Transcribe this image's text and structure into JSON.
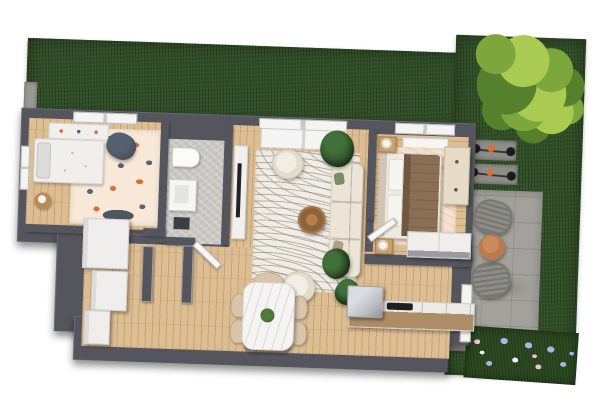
{
  "meta": {
    "title": "3D top-down floor plan rendering of a house with garden",
    "render_type": "architectural-visualization",
    "canvas": {
      "width": 600,
      "height": 420
    }
  },
  "palette": {
    "bg": "#ffffff",
    "grass": "#33502a",
    "treeLight": "#a9cb52",
    "treeMid": "#7da73d",
    "treeDark": "#55802c",
    "wall": "#55555d",
    "wood": "#ddbd92",
    "tile": "#cbc8c3",
    "stone": "#a3a19c",
    "rugCream": "#f1ede5",
    "rugKids": "#f8e8d8",
    "rugBedroom": "#f5e3d0",
    "sofa": "#ece5d7",
    "accentOrange": "#d96f35",
    "terracotta": "#b97a4e",
    "blanket": "#8a6f54",
    "flowerBlue": "#a9b3e6",
    "flowerPink": "#e9c2d8",
    "counterWood": "#ad8d66",
    "cooktop": "#1f1f22",
    "metal": "#b9bcc1"
  },
  "scene": {
    "garden": {
      "lawn_label": "grass lawn",
      "tree_label": "large tree",
      "bicycles_label": "two parked bicycles",
      "patio_label": "stone patio with two wicker chairs and round table",
      "flowerbed_label": "hydrangea flower bed",
      "stone_pad_label": "stone pad"
    },
    "house": {
      "rooms": [
        {
          "key": "kids_room",
          "label": "kids room",
          "furniture": [
            "bed",
            "shelf",
            "play rug",
            "bean bag",
            "side table"
          ]
        },
        {
          "key": "bathroom",
          "label": "bathroom",
          "furniture": [
            "toilet",
            "washbasin",
            "bath mat"
          ]
        },
        {
          "key": "living_room",
          "label": "living room",
          "furniture": [
            "sofa",
            "armchair",
            "armchair",
            "coffee table",
            "area rug",
            "tv unit",
            "potted plants"
          ]
        },
        {
          "key": "bedroom",
          "label": "bedroom",
          "furniture": [
            "double bed",
            "nightstands with lamps",
            "dresser",
            "wardrobe",
            "area rug"
          ]
        },
        {
          "key": "hall_dining",
          "label": "hall and dining",
          "furniture": [
            "entry cabinets",
            "dining table",
            "dining chairs"
          ]
        },
        {
          "key": "kitchen",
          "label": "kitchen",
          "furniture": [
            "counter",
            "cooktop",
            "appliance"
          ]
        }
      ]
    }
  }
}
